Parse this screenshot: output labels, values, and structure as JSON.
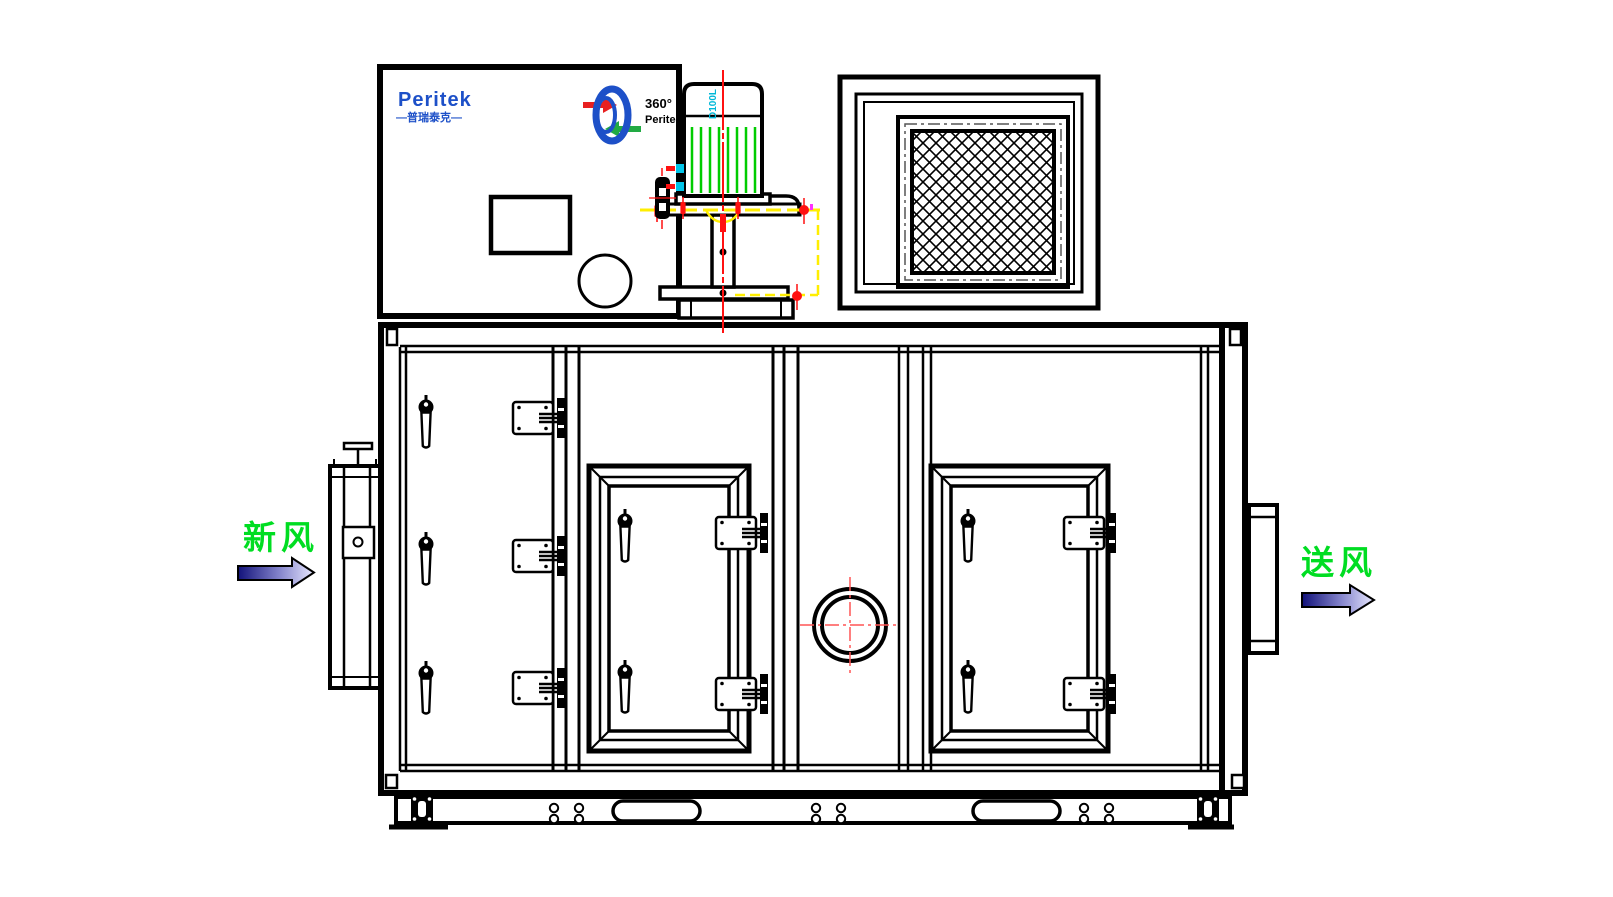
{
  "brand": {
    "name": "Peritek",
    "cn_subtext": "—普瑞泰克—",
    "rotor_caption_top": "360°",
    "rotor_caption_bottom": "Peritek"
  },
  "motor": {
    "frame_label": "D100L"
  },
  "flow_labels": {
    "fresh_air": "新风",
    "supply_air": "送风"
  },
  "colors": {
    "line_black": "#000000",
    "brand_blue": "#1d50c8",
    "fin_green": "#00cc00",
    "centerline_red": "#ff1111",
    "marker_yellow": "#ffee00",
    "marker_cyan": "#00c4e8",
    "marker_magenta": "#ff33ff",
    "label_green": "#00dd22",
    "arrow_gradient_start": "#12127a",
    "arrow_gradient_end": "#e8e8ff"
  }
}
